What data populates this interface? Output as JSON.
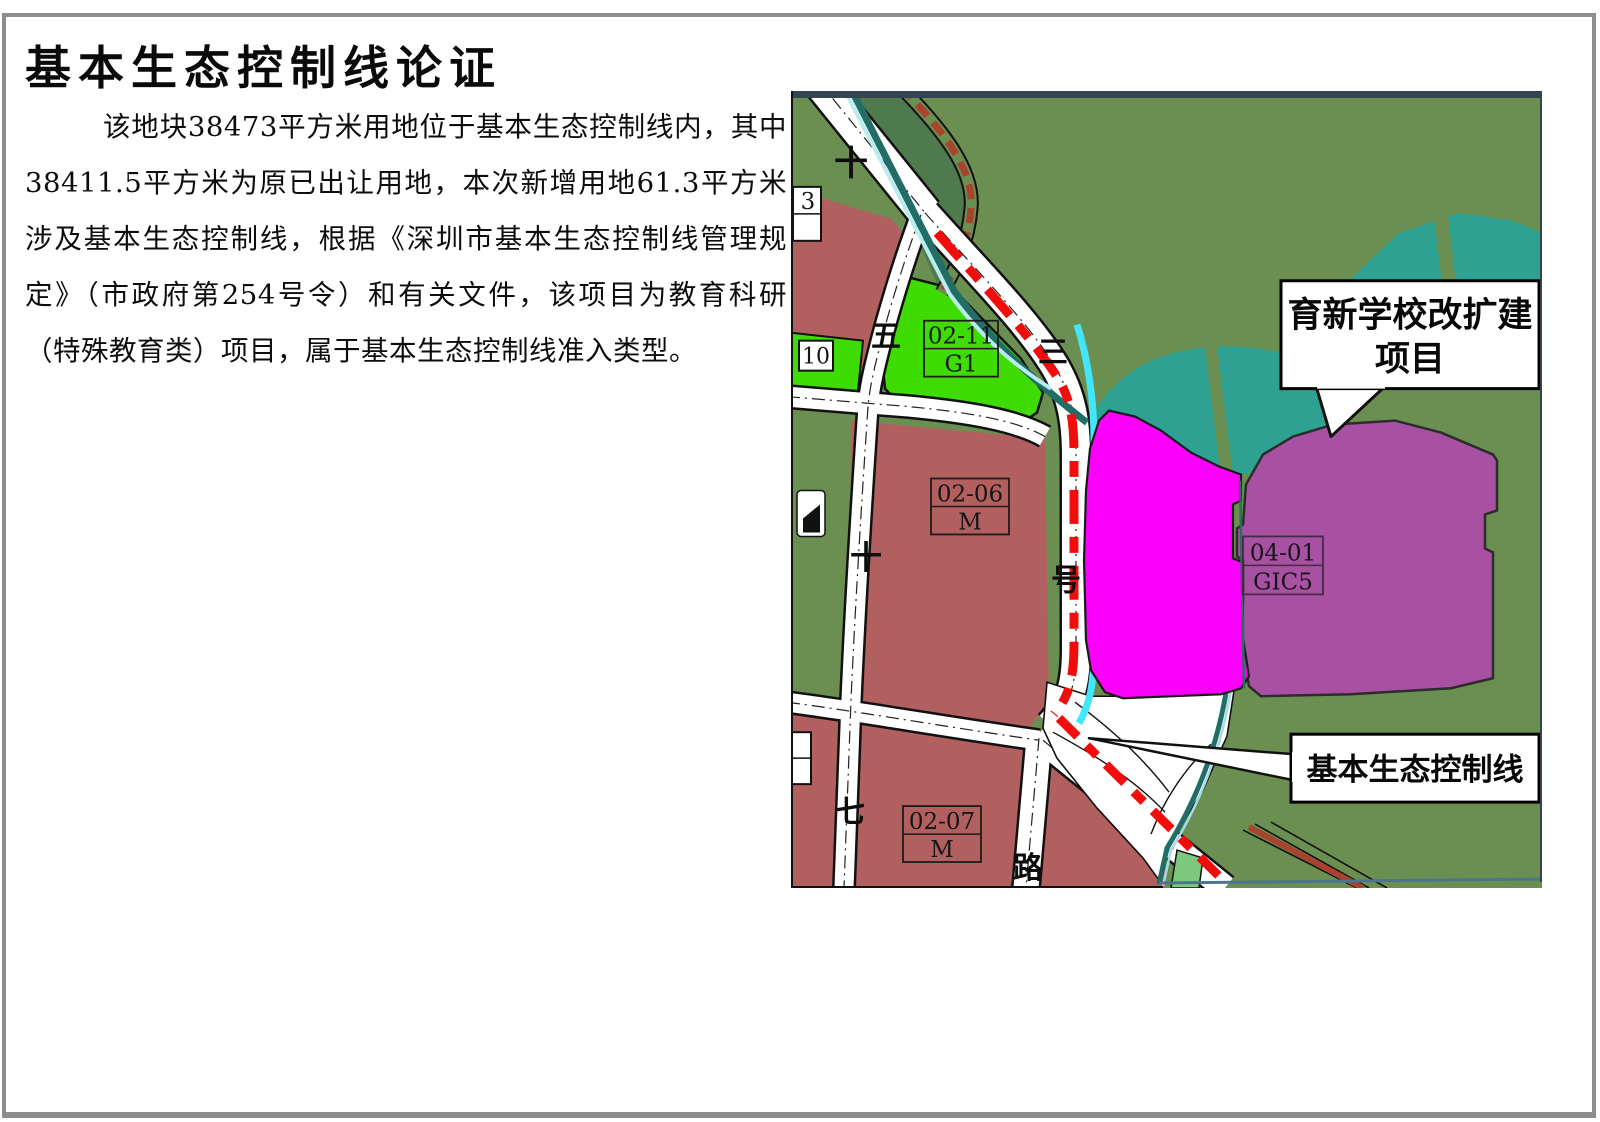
{
  "page": {
    "title": "基本生态控制线论证",
    "paragraph": "该地块38473平方米用地位于基本生态控制线内，其中38411.5平方米为原已出让用地，本次新增用地61.3平方米涉及基本生态控制线，根据《深圳市基本生态控制线管理规定》（市政府第254号令）和有关文件，该项目为教育科研（特殊教育类）项目，属于基本生态控制线准入类型。"
  },
  "map": {
    "callouts": {
      "project_line1": "育新学校改扩建",
      "project_line2": "项目",
      "control_line": "基本生态控制线"
    },
    "parcels": {
      "g1": {
        "code": "02-11",
        "use": "G1"
      },
      "m06": {
        "code": "02-06",
        "use": "M"
      },
      "m07": {
        "code": "02-07",
        "use": "M"
      },
      "gic5": {
        "code": "04-01",
        "use": "GIC5"
      },
      "partial_top": "3",
      "partial_mid": "10"
    },
    "road_labels": {
      "shi_top": "十",
      "wu": "五",
      "san": "三",
      "hao": "号",
      "shi_mid": "十",
      "qi": "七",
      "lu": "路"
    },
    "colors": {
      "ecological_green": "#6b8f50",
      "dark_green": "#4f7a4e",
      "water_teal": "#2fa193",
      "stream_cyan": "#41e6fb",
      "boundary_teal": "#226e66",
      "industry_rose": "#b25f5f",
      "park_green": "#3fdc04",
      "project_magenta": "#fb00fb",
      "school_purple": "#a851a3",
      "control_line_red": "#f20d0d"
    }
  }
}
